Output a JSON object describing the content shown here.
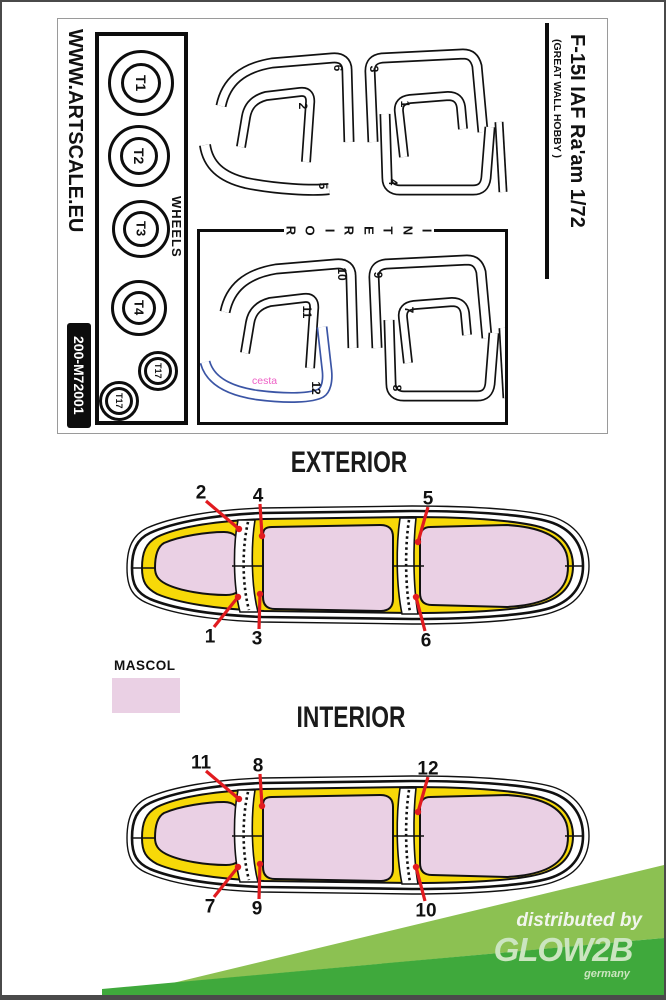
{
  "sheet": {
    "website": "WWW.ARTSCALE.EU",
    "product_code": "200-M72001",
    "wheels_section_label": "WHEELS",
    "wheels": [
      "T1",
      "T2",
      "T3",
      "T4",
      "T17",
      "T17"
    ],
    "title": "F-15I IAF Ra'am 1/72",
    "subtitle": "(GREAT WALL HOBBY )",
    "exterior_mask_labels": {
      "corner_band": "6",
      "front_hook": "2",
      "bottom_arc": "5",
      "mid_frame": "3",
      "rear_hook": "1",
      "rear_frame": "4"
    },
    "interior_mask_labels": {
      "corner_band": "10",
      "front_hook": "11",
      "mid_frame": "9",
      "rear_hook": "7",
      "rear_frame": "8",
      "blue_band": "12"
    },
    "interior_border_label": "INTERIOR",
    "cut_path_label": "cesta"
  },
  "exterior_diagram": {
    "heading": "EXTERIOR",
    "callouts_top": [
      "2",
      "4",
      "5"
    ],
    "callouts_bottom": [
      "1",
      "3",
      "6"
    ]
  },
  "interior_diagram": {
    "heading": "INTERIOR",
    "callouts_top": [
      "11",
      "8",
      "12"
    ],
    "callouts_bottom": [
      "7",
      "9",
      "10"
    ]
  },
  "legend": {
    "label": "MASCOL"
  },
  "footer": {
    "distributed_by": "distributed by",
    "brand": "GLOW2B",
    "country": "germany"
  },
  "colors": {
    "mask_yellow": "#f7d908",
    "mascol_pink": "#ead0e4",
    "callout_red": "#e11b1f",
    "outline_blue": "#3b55a5",
    "path_label_pink": "#ee5fc6",
    "banner_light_green": "#8cc152",
    "banner_dark_green": "#3fa93c",
    "banner_text_pale": "#cbe5c0"
  }
}
